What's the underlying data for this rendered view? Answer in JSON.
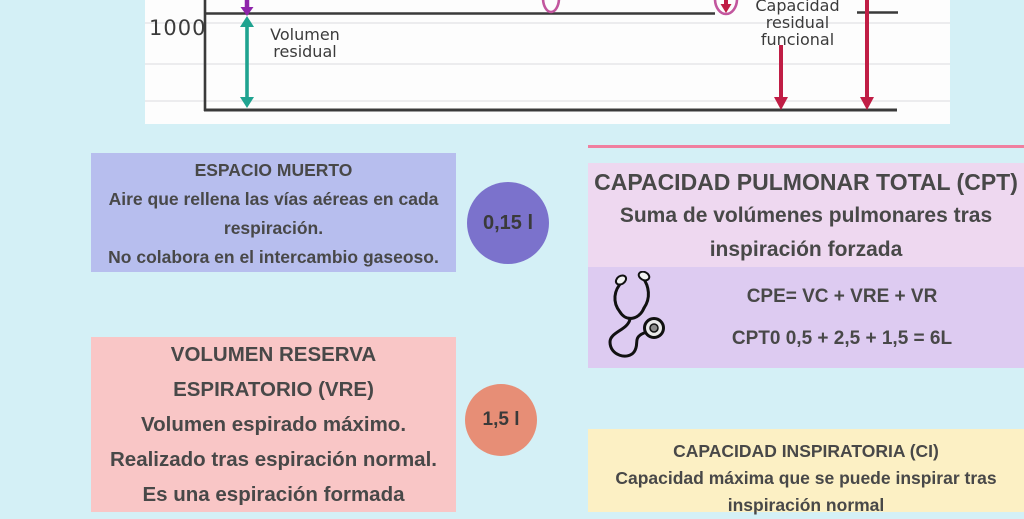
{
  "colors": {
    "page_bg": "#d4f0f6",
    "panel_bg": "#fdfdfd",
    "chart_line": "#3a3a3a",
    "gridline": "#e6e6e9",
    "arrow_purple": "#8e24aa",
    "arrow_teal": "#1fa390",
    "arrow_crimson": "#c01d45",
    "ellipse_magenta": "#c2569e",
    "espacio_bg": "#b7beee",
    "espacio_circle": "#7b72cc",
    "cpt_title_bg": "#eed8f0",
    "cpt_formula_bg": "#ddcbf1",
    "cpt_topline": "#f07f9f",
    "vre_bg": "#f9c6c6",
    "vre_circle": "#e78e76",
    "ci_bg": "#fcf0c4",
    "text_dark": "#484848"
  },
  "chart": {
    "y_tick": "1000",
    "volumen_residual_line1": "Volumen",
    "volumen_residual_line2": "residual",
    "capacidad_line1": "Capacidad",
    "capacidad_line2": "residual funcional"
  },
  "espacio": {
    "title": "ESPACIO MUERTO",
    "line1": "Aire que rellena las vías aéreas en cada",
    "line2": "respiración.",
    "line3": "No colabora en el intercambio gaseoso.",
    "value": "0,15 l"
  },
  "cpt": {
    "title": "CAPACIDAD PULMONAR TOTAL (CPT)",
    "subtitle_line1": "Suma de volúmenes pulmonares tras",
    "subtitle_line2": "inspiración forzada",
    "formula1": "CPE= VC + VRE + VR",
    "formula2": "CPT0 0,5 + 2,5 + 1,5 = 6L"
  },
  "vre": {
    "title_line1": "VOLUMEN RESERVA",
    "title_line2": "ESPIRATORIO (VRE)",
    "line1": "Volumen espirado máximo.",
    "line2": "Realizado tras espiración normal.",
    "line3": "Es una espiración formada",
    "value": "1,5 l"
  },
  "ci": {
    "title": "CAPACIDAD INSPIRATORIA (CI)",
    "line1": "Capacidad máxima que se puede inspirar tras",
    "line2": "inspiración normal"
  }
}
